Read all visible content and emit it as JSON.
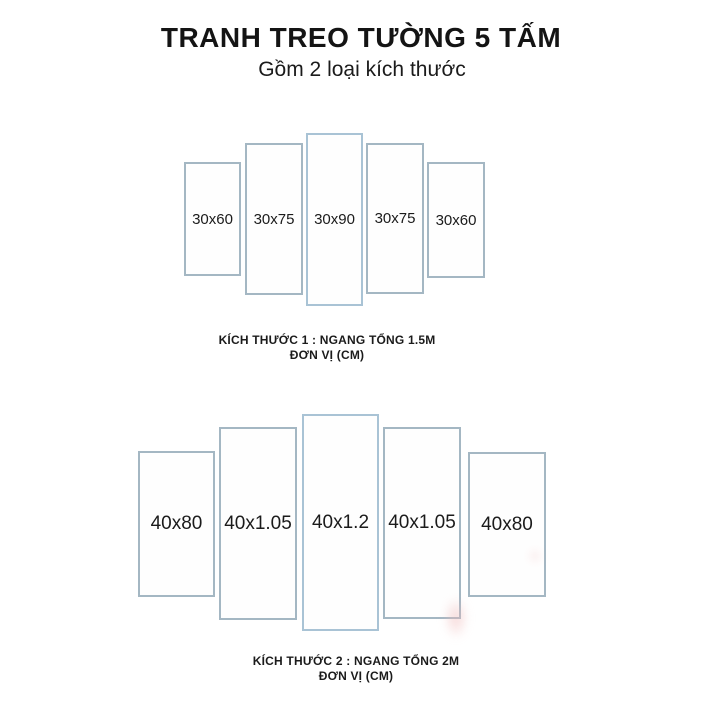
{
  "header": {
    "title": "TRANH TREO TƯỜNG 5 TẤM",
    "subtitle": "Gồm 2 loại kích thước"
  },
  "sets": [
    {
      "name": "size-1",
      "panels": [
        {
          "label": "30x60"
        },
        {
          "label": "30x75"
        },
        {
          "label": "30x90"
        },
        {
          "label": "30x75"
        },
        {
          "label": "30x60"
        }
      ],
      "caption_line1": "KÍCH THƯỚC 1 : NGANG TỔNG 1.5M",
      "caption_line2": "ĐƠN VỊ (CM)"
    },
    {
      "name": "size-2",
      "panels": [
        {
          "label": "40x80"
        },
        {
          "label": "40x1.05"
        },
        {
          "label": "40x1.2"
        },
        {
          "label": "40x1.05"
        },
        {
          "label": "40x80"
        }
      ],
      "caption_line1": "KÍCH THƯỚC 2 : NGANG TỔNG 2M",
      "caption_line2": "ĐƠN VỊ (CM)"
    }
  ],
  "colors": {
    "background": "#ffffff",
    "panel_border": "#a4b7c3",
    "panel_border_center": "#a9c3d5",
    "text": "#1b1b1b",
    "watermark_pink": "#f0b9b9"
  }
}
